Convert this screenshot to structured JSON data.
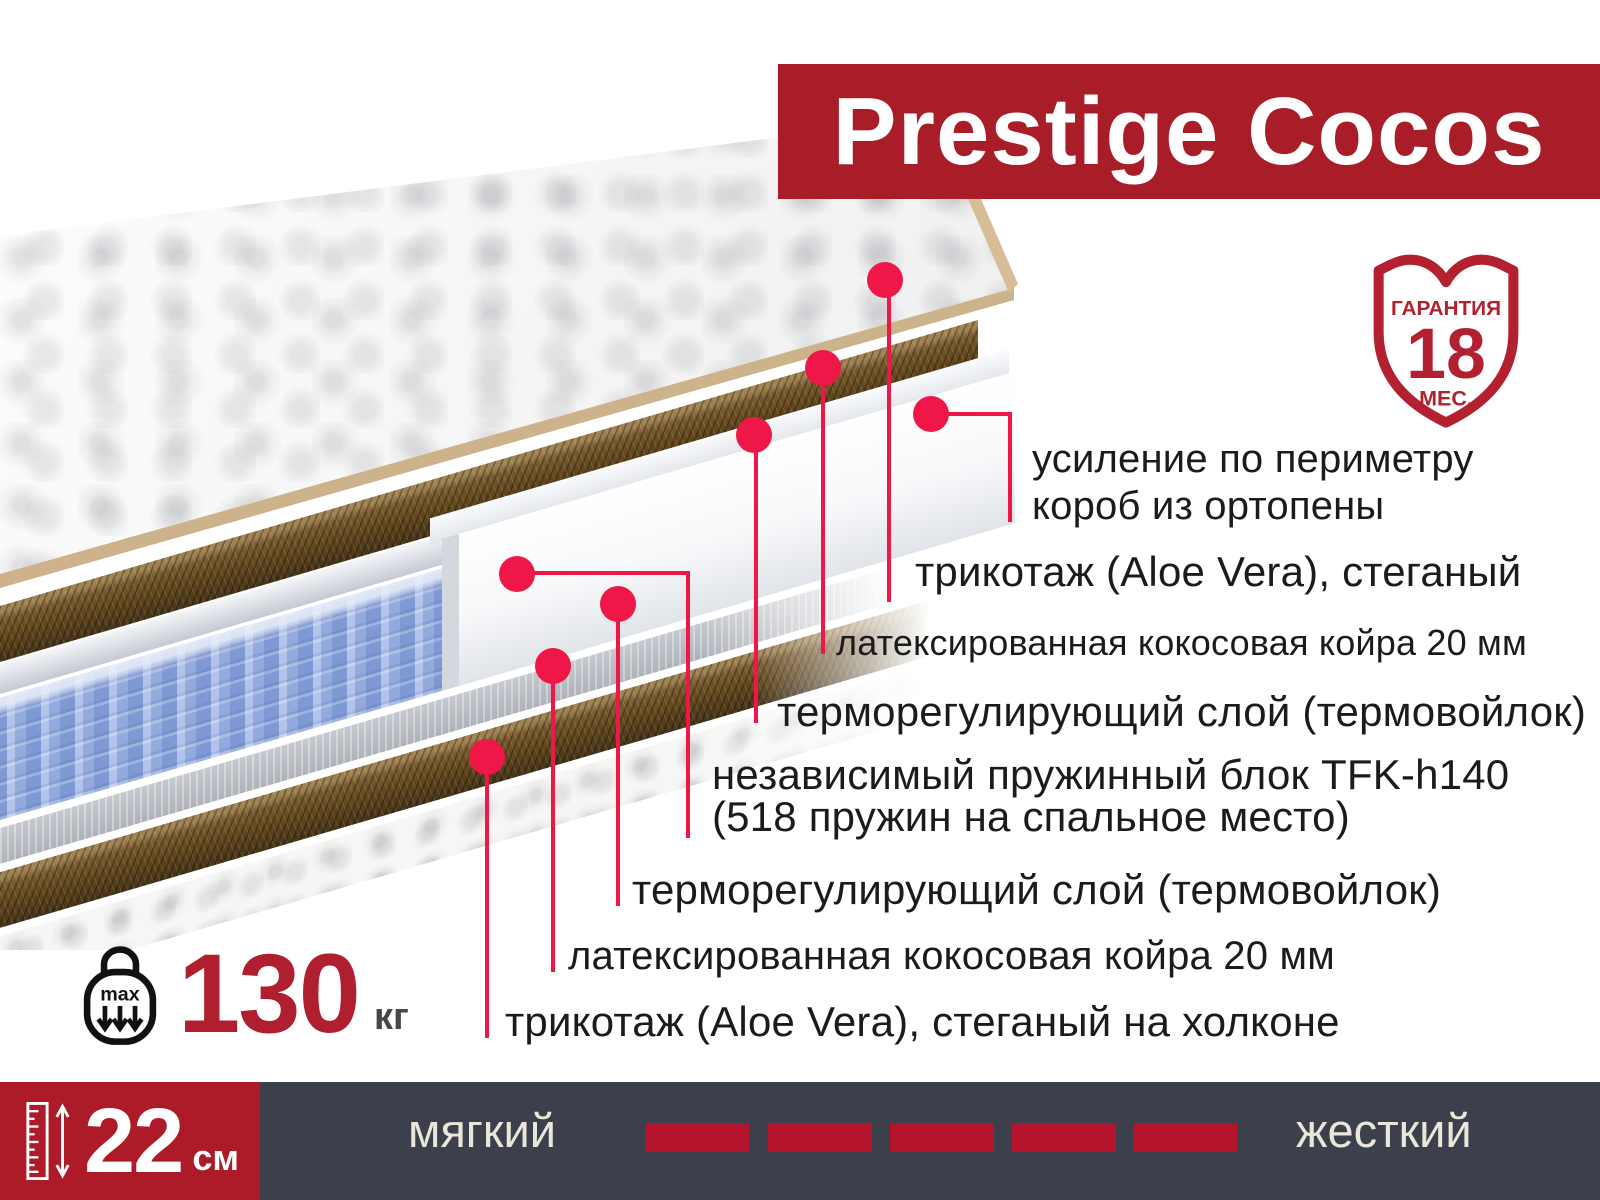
{
  "product": {
    "title": "Prestige Cocos"
  },
  "warranty": {
    "label_top": "ГАРАНТИЯ",
    "months": "18",
    "label_bottom": "МЕС."
  },
  "layers": [
    {
      "lines": [
        "усиление по периметру",
        "короб из ортопены"
      ]
    },
    {
      "lines": [
        "трикотаж (Aloe Vera), стеганый"
      ]
    },
    {
      "lines": [
        "латексированная кокосовая койра 20 мм"
      ]
    },
    {
      "lines": [
        "терморегулирующий слой (термовойлок)"
      ]
    },
    {
      "lines": [
        "независимый пружинный блок TFK-h140",
        "(518 пружин на спальное место)"
      ]
    },
    {
      "lines": [
        "терморегулирующий слой (термовойлок)"
      ]
    },
    {
      "lines": [
        "латексированная кокосовая койра 20 мм"
      ]
    },
    {
      "lines": [
        "трикотаж (Aloe Vera), стеганый на холконе"
      ]
    }
  ],
  "max_load": {
    "badge": "max",
    "value": "130",
    "unit": "кг"
  },
  "height": {
    "value": "22",
    "unit": "см"
  },
  "firmness_scale": {
    "soft": "мягкий",
    "hard": "жесткий",
    "segments": 5
  },
  "colors": {
    "banner_red": "#a91d28",
    "accent_pink_red": "#ee1747",
    "shield_red": "#b3202f",
    "height_block_red": "#ad1b29",
    "dash_red": "#b5152c",
    "bar_dark": "#3c404d",
    "cream_text": "#eae6d9",
    "weight_red": "#b01f30",
    "text_dark": "#1b1b1b"
  }
}
